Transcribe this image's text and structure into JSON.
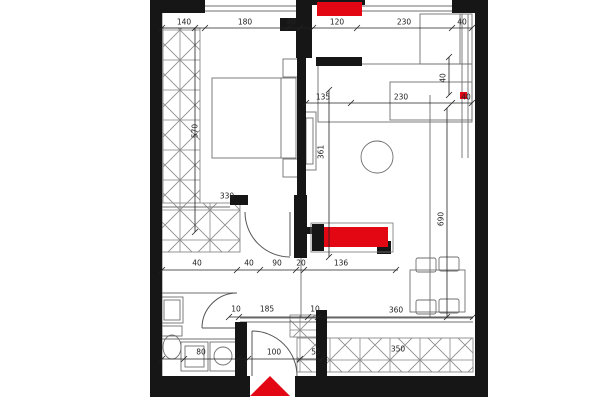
{
  "floor_plan": {
    "colors": {
      "red": "#e30613",
      "wall": "#161616",
      "line": "#6f6f6f",
      "dim": "#222222",
      "hatch": "#8a8a8a",
      "bg": "#ffffff"
    },
    "markers": {
      "entrance_triangle": "entrance-marker",
      "shaft_top": "riser-shaft",
      "shaft_middle": "riser-shaft"
    },
    "dimension_labels": [
      {
        "text": "140",
        "x": 184,
        "y": 22,
        "rot": 0
      },
      {
        "text": "180",
        "x": 245,
        "y": 22,
        "rot": 0
      },
      {
        "text": "40",
        "x": 291,
        "y": 22,
        "rot": 0
      },
      {
        "text": "120",
        "x": 337,
        "y": 22,
        "rot": 0
      },
      {
        "text": "230",
        "x": 404,
        "y": 22,
        "rot": 0
      },
      {
        "text": "40",
        "x": 462,
        "y": 22,
        "rot": 0
      },
      {
        "text": "135",
        "x": 323,
        "y": 97,
        "rot": 0
      },
      {
        "text": "230",
        "x": 401,
        "y": 97,
        "rot": 0
      },
      {
        "text": "40",
        "x": 466,
        "y": 97,
        "rot": 0
      },
      {
        "text": "330",
        "x": 227,
        "y": 196,
        "rot": 0
      },
      {
        "text": "40",
        "x": 197,
        "y": 263,
        "rot": 0
      },
      {
        "text": "40",
        "x": 249,
        "y": 263,
        "rot": 0
      },
      {
        "text": "90",
        "x": 277,
        "y": 263,
        "rot": 0
      },
      {
        "text": "20",
        "x": 301,
        "y": 263,
        "rot": 0
      },
      {
        "text": "136",
        "x": 341,
        "y": 263,
        "rot": 0
      },
      {
        "text": "10",
        "x": 236,
        "y": 309,
        "rot": 0
      },
      {
        "text": "185",
        "x": 267,
        "y": 309,
        "rot": 0
      },
      {
        "text": "10",
        "x": 315,
        "y": 309,
        "rot": 0
      },
      {
        "text": "360",
        "x": 396,
        "y": 310,
        "rot": 0
      },
      {
        "text": "80",
        "x": 201,
        "y": 352,
        "rot": 0
      },
      {
        "text": "100",
        "x": 274,
        "y": 352,
        "rot": 0
      },
      {
        "text": "55",
        "x": 316,
        "y": 352,
        "rot": 0
      },
      {
        "text": "350",
        "x": 398,
        "y": 349,
        "rot": 0
      },
      {
        "text": "570",
        "x": 195,
        "y": 131,
        "rot": -90
      },
      {
        "text": "361",
        "x": 321,
        "y": 152,
        "rot": -90
      },
      {
        "text": "690",
        "x": 441,
        "y": 219,
        "rot": -90
      },
      {
        "text": "40",
        "x": 443,
        "y": 78,
        "rot": -90
      }
    ]
  }
}
